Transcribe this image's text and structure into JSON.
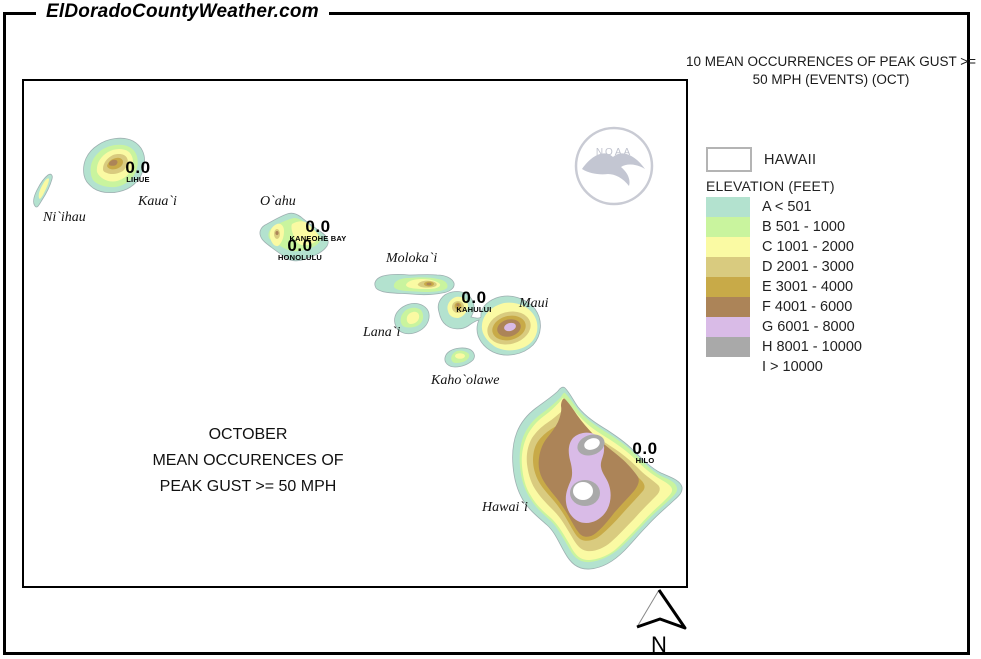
{
  "header": {
    "site_name": "ElDoradoCountyWeather.com"
  },
  "title": {
    "line1": "10 MEAN OCCURRENCES OF PEAK GUST >=",
    "line2": "50 MPH (EVENTS) (OCT)"
  },
  "map": {
    "caption": {
      "line1": "OCTOBER",
      "line2": "MEAN OCCURENCES OF",
      "line3": "PEAK GUST >= 50 MPH"
    },
    "islands": {
      "niihau": "Ni`ihau",
      "kauai": "Kaua`i",
      "oahu": "O`ahu",
      "molokai": "Moloka`i",
      "lanai": "Lana`i",
      "maui": "Maui",
      "kahoolawe": "Kaho`olawe",
      "hawaii": "Hawai`i"
    },
    "stations": [
      {
        "name": "LIHUE",
        "value": "0.0"
      },
      {
        "name": "KANEOHE BAY",
        "value": "0.0"
      },
      {
        "name": "HONOLULU",
        "value": "0.0"
      },
      {
        "name": "KAHULUI",
        "value": "0.0"
      },
      {
        "name": "HILO",
        "value": "0.0"
      }
    ]
  },
  "legend": {
    "region_label": "HAWAII",
    "elevation_title": "ELEVATION (FEET)",
    "bands": [
      {
        "code": "A",
        "label": "A < 501",
        "color": "#b3e2cf"
      },
      {
        "code": "B",
        "label": "B 501 - 1000",
        "color": "#c9f49e"
      },
      {
        "code": "C",
        "label": "C 1001 - 2000",
        "color": "#fafaa3"
      },
      {
        "code": "D",
        "label": "D 2001 - 3000",
        "color": "#d9cb7f"
      },
      {
        "code": "E",
        "label": "E 3001 - 4000",
        "color": "#c8aa48"
      },
      {
        "code": "F",
        "label": "F 4001 - 6000",
        "color": "#ac8458"
      },
      {
        "code": "G",
        "label": "G 6001 - 8000",
        "color": "#d9bbe7"
      },
      {
        "code": "H",
        "label": "H 8001 - 10000",
        "color": "#a9a9a9"
      },
      {
        "code": "I",
        "label": "I > 10000",
        "color": "#ffffff"
      }
    ]
  },
  "noaa": {
    "text": "NOAA"
  },
  "compass": {
    "north_label": "N"
  }
}
